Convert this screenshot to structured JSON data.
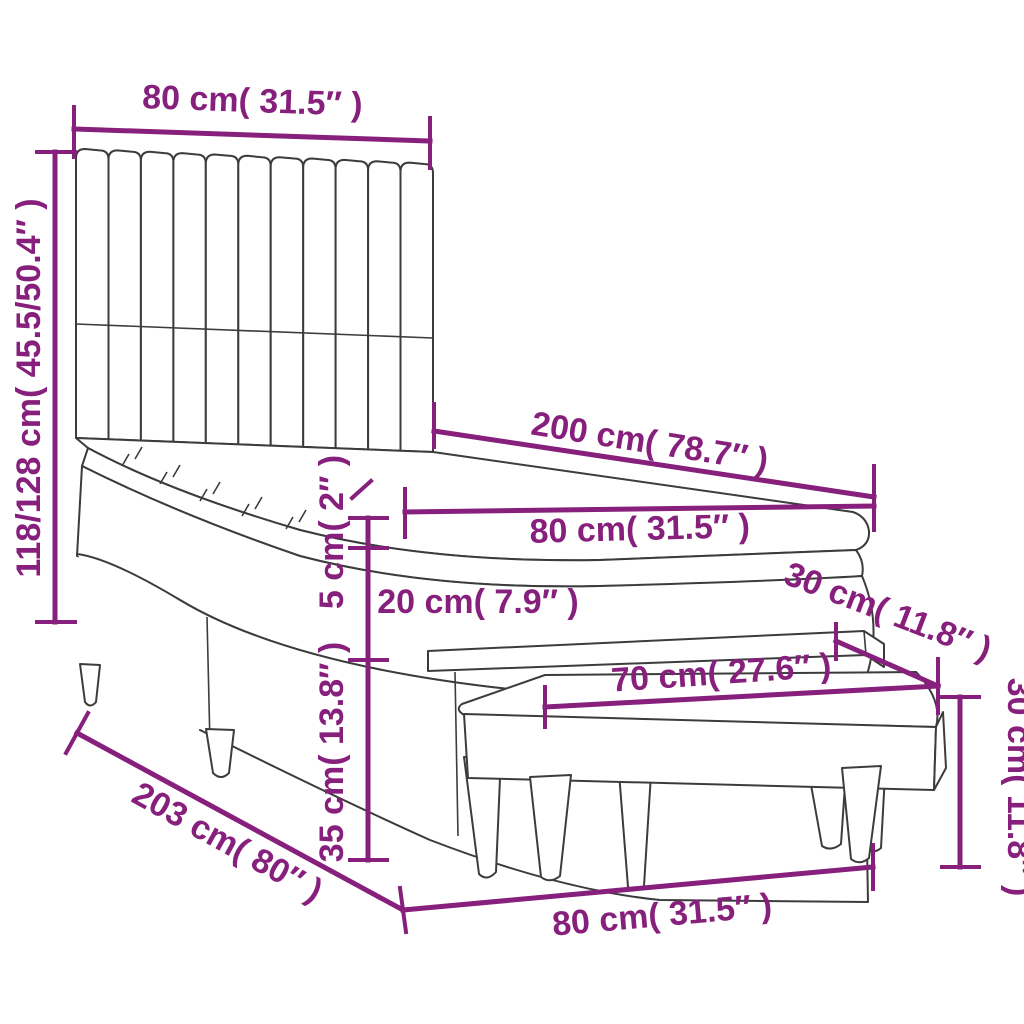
{
  "diagram": {
    "kind": "furniture-dimension-diagram",
    "product": "box spring bed with vertical-slat headboard, mattress, topper and bench",
    "accent_color": "#871f7c",
    "line_color": "#3c3c3c",
    "background_color": "#ffffff",
    "labels": {
      "headboard_width": "80 cm( 31.5″ )",
      "total_height": "118/128 cm( 45.5/50.4″ )",
      "bed_length": "200 cm( 78.7″ )",
      "bed_width": "80 cm( 31.5″ )",
      "topper_height": "5 cm( 2″ )",
      "mattress_height": "20 cm( 7.9″ )",
      "base_height": "35 cm( 13.8″ )",
      "base_length": "203 cm( 80″ )",
      "bench_depth": "30 cm( 11.8″ )",
      "bench_length": "70 cm( 27.6″ )",
      "bench_total_width": "80 cm( 31.5″ )",
      "bench_height": "30 cm( 11.8″ )"
    },
    "measurements": [
      {
        "part": "headboard width",
        "cm": "80",
        "inches": "31.5"
      },
      {
        "part": "total height (two options)",
        "cm": "118/128",
        "inches": "45.5/50.4"
      },
      {
        "part": "bed length",
        "cm": "200",
        "inches": "78.7"
      },
      {
        "part": "bed width",
        "cm": "80",
        "inches": "31.5"
      },
      {
        "part": "topper thickness",
        "cm": "5",
        "inches": "2"
      },
      {
        "part": "mattress thickness",
        "cm": "20",
        "inches": "7.9"
      },
      {
        "part": "box spring base height",
        "cm": "35",
        "inches": "13.8"
      },
      {
        "part": "base total length",
        "cm": "203",
        "inches": "80"
      },
      {
        "part": "bench depth",
        "cm": "30",
        "inches": "11.8"
      },
      {
        "part": "bench seat length",
        "cm": "70",
        "inches": "27.6"
      },
      {
        "part": "bench total length",
        "cm": "80",
        "inches": "31.5"
      },
      {
        "part": "bench height",
        "cm": "30",
        "inches": "11.8"
      }
    ]
  }
}
